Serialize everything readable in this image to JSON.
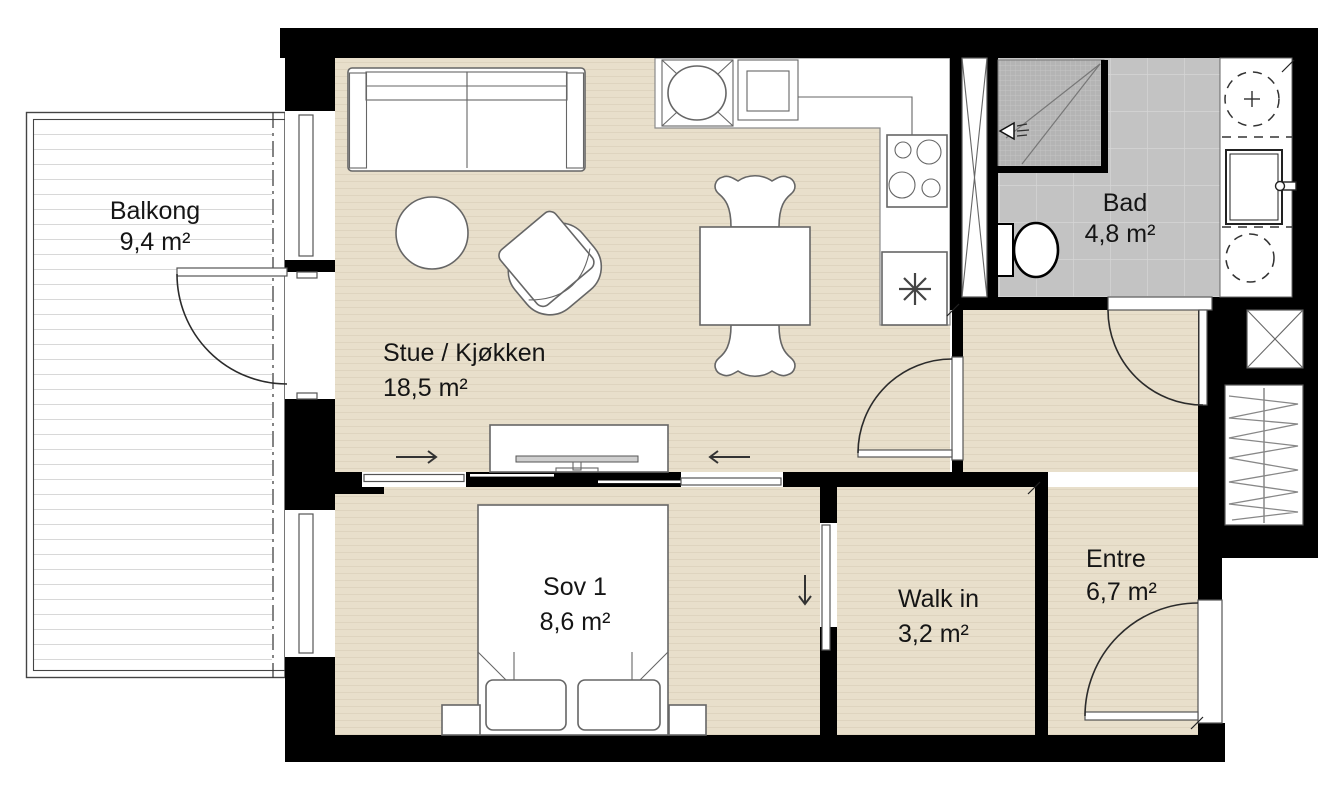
{
  "colors": {
    "wall": "#000000",
    "floor": "#e8dfcb",
    "floor-stripe": "#ded4bf",
    "tile": "#c3c3c3",
    "tile-line": "#d6d6d6",
    "shower": "#b4b4b4",
    "shower-line": "#c8c8c8",
    "deck-line": "#d8d8d8",
    "outline": "#666666",
    "arc": "#2b2b2b",
    "text": "#151515"
  },
  "rooms": [
    {
      "id": "balkong",
      "label": "Balkong",
      "area": "9,4 m²"
    },
    {
      "id": "stue-kjokken",
      "label": "Stue / Kjøkken",
      "area": "18,5 m²"
    },
    {
      "id": "bad",
      "label": "Bad",
      "area": "4,8 m²"
    },
    {
      "id": "sov-1",
      "label": "Sov 1",
      "area": "8,6 m²"
    },
    {
      "id": "walk-in",
      "label": "Walk in",
      "area": "3,2 m²"
    },
    {
      "id": "entre",
      "label": "Entre",
      "area": "6,7 m²"
    }
  ]
}
